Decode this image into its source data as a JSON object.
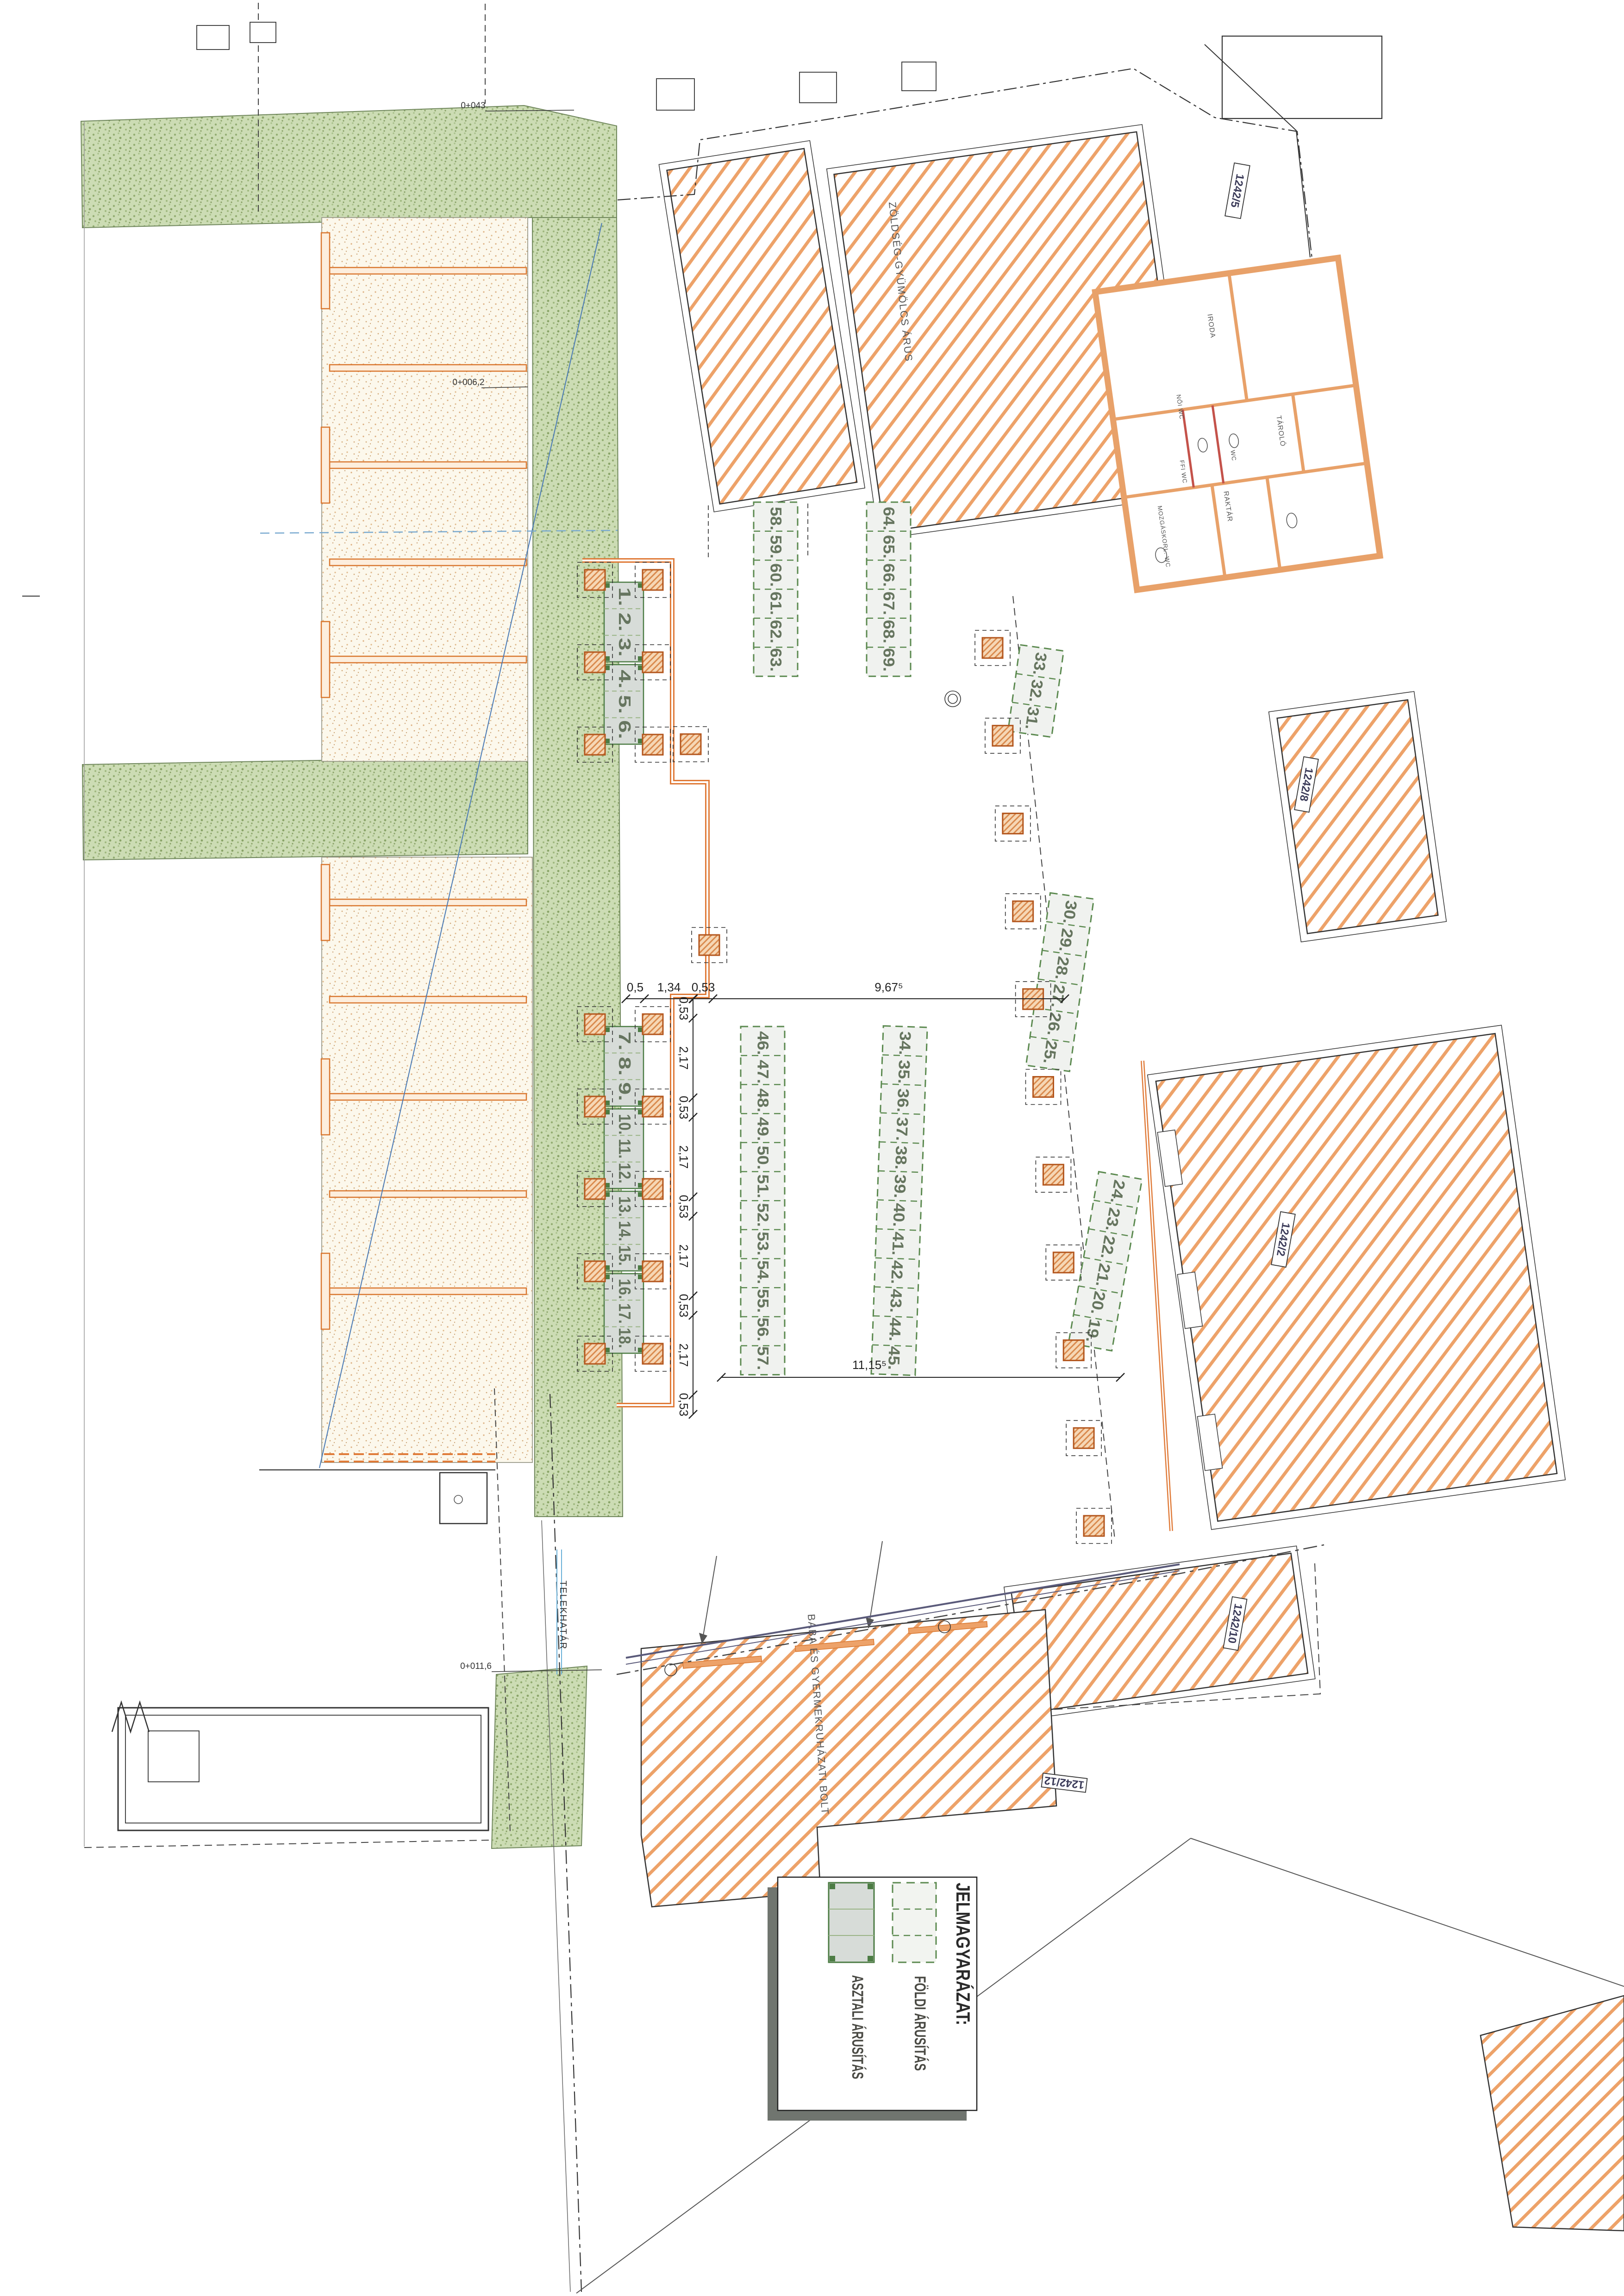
{
  "legend": {
    "title": "JELMAGYARÁZAT:",
    "items": [
      {
        "symbol": "dashed-green-rect",
        "label": "FÖLDI ÁRUSÍTÁS"
      },
      {
        "symbol": "solid-green-table",
        "label": "ASZTALI ÁRUSÍTÁS"
      }
    ]
  },
  "stall_tables": {
    "groups": [
      {
        "numbers": "1. 2. 3."
      },
      {
        "numbers": "4. 5. 6."
      },
      {
        "numbers": "7. 8. 9."
      },
      {
        "numbers": "10. 11. 12."
      },
      {
        "numbers": "13. 14. 15."
      },
      {
        "numbers": "16. 17. 18."
      }
    ]
  },
  "ground_areas": {
    "groups": [
      {
        "numbers": "58. 59. 60. 61. 62. 63."
      },
      {
        "numbers": "64. 65. 66. 67. 68. 69."
      },
      {
        "numbers": "33. 32. 31."
      },
      {
        "numbers": "30. 29. 28. 27. 26. 25."
      },
      {
        "numbers": "24. 23. 22. 21. 20. 19."
      },
      {
        "numbers": "46. 47. 48. 49. 50. 51. 52. 53. 54. 55. 56. 57."
      },
      {
        "numbers": "34. 35. 36. 37. 38. 39. 40. 41. 42. 43. 44. 45."
      }
    ]
  },
  "dimensions": {
    "horizontal_top": [
      "0,5",
      "1,34",
      "0,53",
      "9,67⁵"
    ],
    "vertical_chain": [
      "0,53",
      "2,17",
      "0,53",
      "2,17",
      "0,53",
      "2,17",
      "0,53",
      "2,17",
      "0,53"
    ],
    "bottom": "11,15⁵"
  },
  "parcels": [
    "1242/5",
    "1242/8",
    "1242/2",
    "1242/10",
    "1242/12"
  ],
  "buildings": {
    "shop1": "ZÖLDSÉG-GYÜMÖLCS ÁRUS",
    "shop2": "BABA ÉS GYERMEKRUHÁZATI BOLT",
    "rooms": [
      "IRODA",
      "TÁROLÓ",
      "WC",
      "NŐI WC",
      "FFI WC",
      "RAKTÁR",
      "MOZGÁSKORL. WC"
    ]
  },
  "site": {
    "boundary_label": "TELEKHATÁR",
    "stations": [
      "0+043",
      "0+006,2",
      "0+011,6"
    ]
  },
  "colors": {
    "canopy_orange": "#e07b39",
    "hatch_orange": "#eda269",
    "stall_green": "#4c7c44",
    "dashed_green": "#5c8a50",
    "speckle_green": "#b9cda5",
    "table_fill": "#d7dcd8",
    "blue_line": "#4a7ab5"
  }
}
